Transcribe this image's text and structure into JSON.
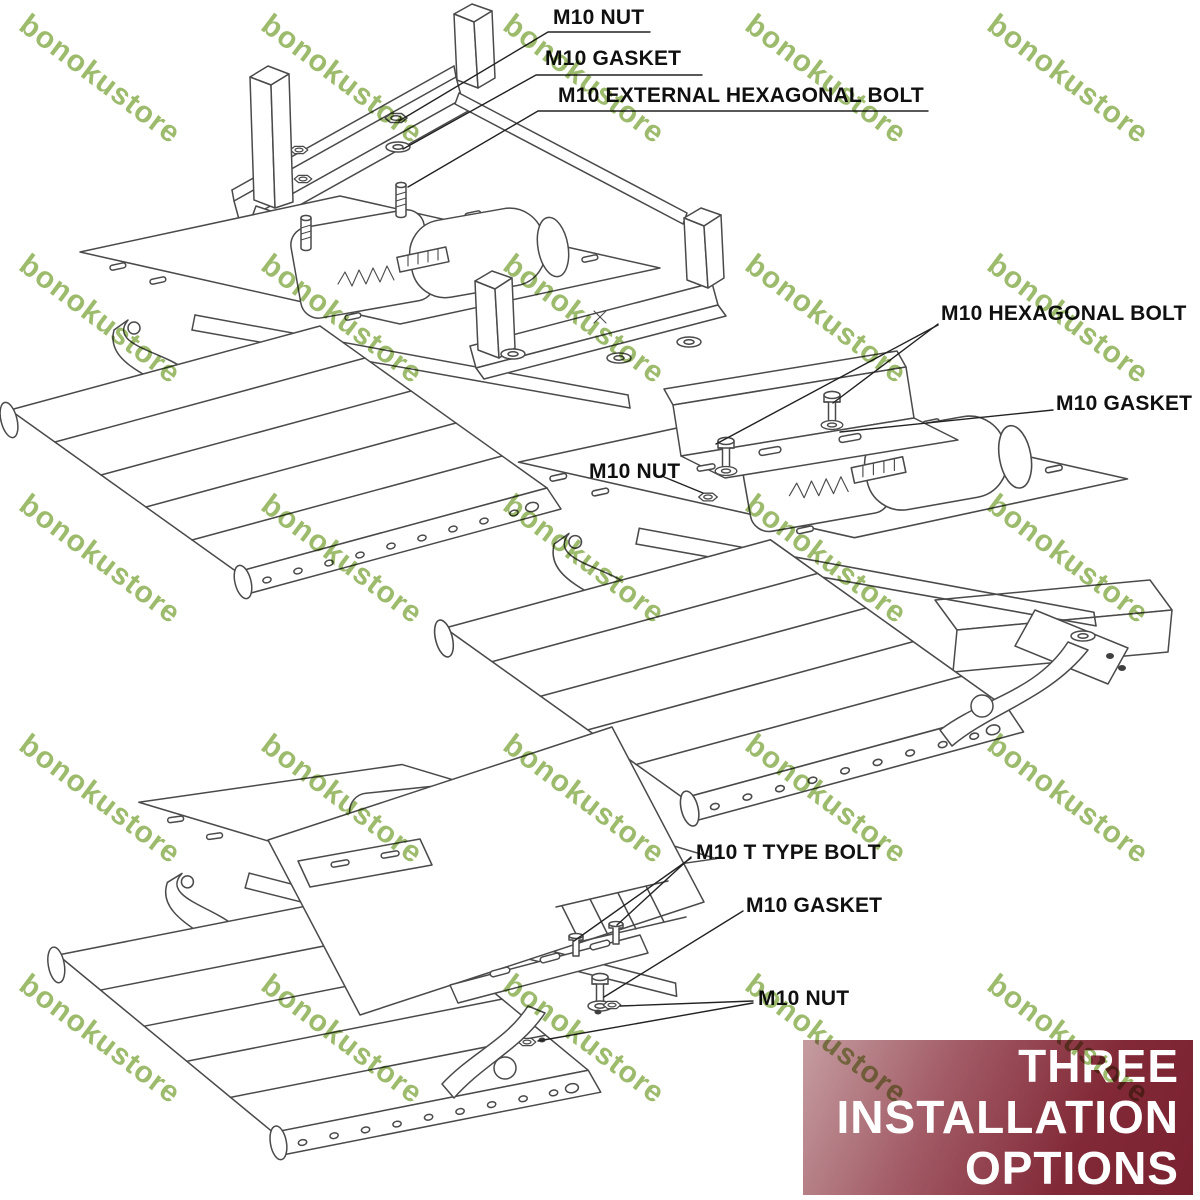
{
  "watermark": {
    "text": "bonokustore",
    "color": "#8fb257",
    "opacity": 0.88,
    "rotation_deg": 37,
    "font_size": 30,
    "grid": {
      "x0": 33,
      "y0": 8,
      "dx": 242,
      "dy": 240,
      "cols": 5,
      "rows": 5
    }
  },
  "diagrams": {
    "top": {
      "labels": {
        "nut": "M10 NUT",
        "gasket": "M10 GASKET",
        "bolt": "M10 EXTERNAL HEXAGONAL BOLT"
      }
    },
    "middle": {
      "labels": {
        "bolt": "M10 HEXAGONAL BOLT",
        "gasket": "M10 GASKET",
        "nut": "M10 NUT"
      }
    },
    "bottom": {
      "labels": {
        "bolt": "M10 T TYPE BOLT",
        "gasket": "M10 GASKET",
        "nut": "M10 NUT"
      }
    }
  },
  "banner": {
    "lines": [
      "THREE",
      "INSTALLATION",
      "OPTIONS"
    ],
    "text_color": "#ffffff",
    "gradient": [
      "#c59da1",
      "#a25b66 35%",
      "#822937 70%",
      "#7a2130 100%"
    ]
  },
  "drawing": {
    "line_color": "#4a4a4a",
    "leader_color": "#222222"
  }
}
